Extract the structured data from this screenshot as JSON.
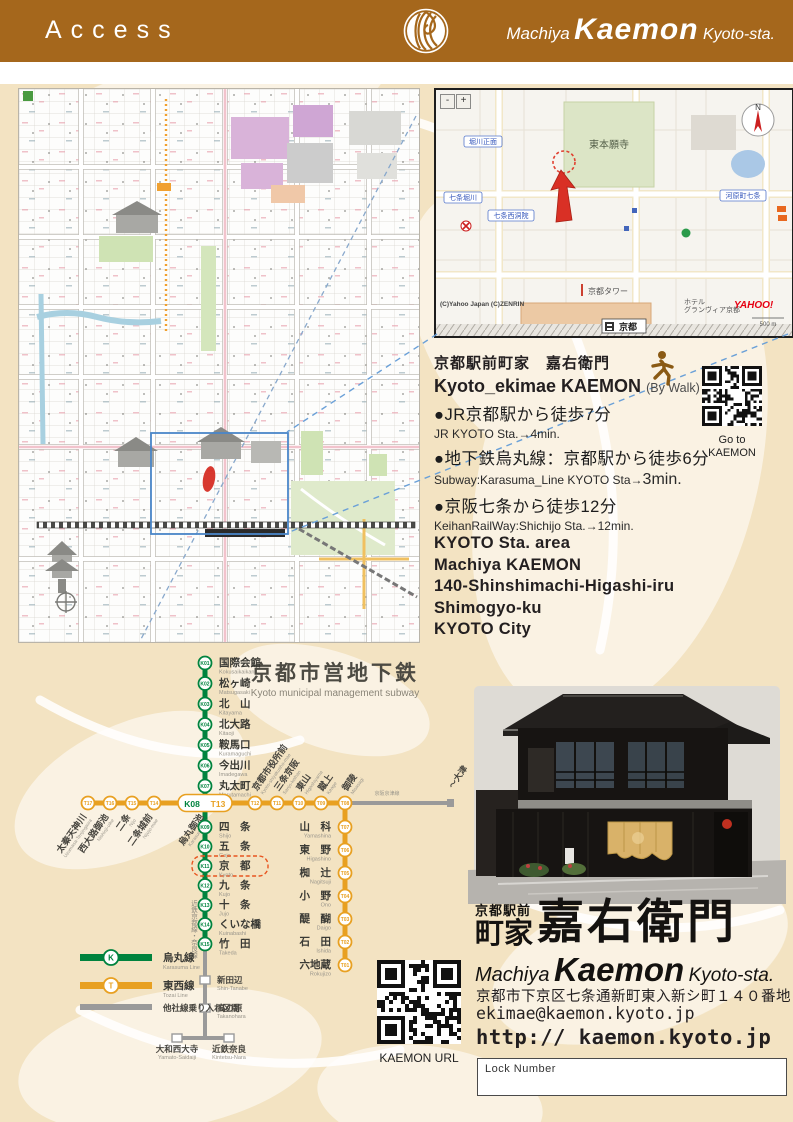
{
  "header": {
    "title": "Access",
    "brand_machiya": "Machiya",
    "brand_name": "Kaemon",
    "brand_suffix": "Kyoto-sta."
  },
  "inset_map": {
    "zoom_out": "-",
    "zoom_in": "+",
    "compass": "N",
    "labels": {
      "honganji": "東本願寺",
      "street_box_1": "堀川正面",
      "street_box_2": "七条堀川",
      "street_box_3": "七条西洞院",
      "street_box_4": "河原町七条",
      "tower": "京都タワー",
      "hotel_1": "ホテル",
      "hotel_2": "グランヴィア京都",
      "isetan": "伊勢丹",
      "station": "京都",
      "attribution": "(C)Yahoo Japan (C)ZENRIN",
      "logo": "YAHOO!",
      "scale": "500 m"
    }
  },
  "access": {
    "title_jp": "京都駅前町家　嘉右衛門",
    "title_en": "Kyoto_ekimae KAEMON",
    "by_walk": "(By Walk)",
    "routes": [
      {
        "jp": "●JR京都駅から徒歩7分",
        "en": "JR KYOTO Sta.→4min."
      },
      {
        "jp": "●地下鉄烏丸線：京都駅から徒歩6分",
        "en": "Subway:Karasuma_Line KYOTO Sta→",
        "en_big": "3min."
      },
      {
        "jp": "●京阪七条から徒歩12分",
        "en": "KeihanRailWay:Shichijo Sta.→12min."
      }
    ],
    "qr_caption_1": "Go to",
    "qr_caption_2": "KAEMON",
    "address_lines": [
      "KYOTO Sta. area",
      "Machiya KAEMON",
      "140-Shinshimachi-Higashi-iru",
      "Shimogyo-ku",
      "KYOTO City"
    ]
  },
  "subway": {
    "title": "京都市営地下鉄",
    "subtitle": "Kyoto municipal management subway",
    "karasuma_upper": [
      {
        "code": "K01",
        "name": "国際会館",
        "romaji": "Kokusaikaikan"
      },
      {
        "code": "K02",
        "name": "松ヶ崎",
        "romaji": "Matsugasaki"
      },
      {
        "code": "K03",
        "name": "北　山",
        "romaji": "Kitayama"
      },
      {
        "code": "K04",
        "name": "北大路",
        "romaji": "Kitaoji"
      },
      {
        "code": "K05",
        "name": "鞍馬口",
        "romaji": "Kuramaguchi"
      },
      {
        "code": "K06",
        "name": "今出川",
        "romaji": "Imadegawa"
      },
      {
        "code": "K07",
        "name": "丸太町",
        "romaji": "Marutamachi"
      }
    ],
    "junction": {
      "codes": [
        "K08",
        "T13"
      ],
      "name": "烏丸御池",
      "romaji": "Karasuma-oike"
    },
    "karasuma_lower": [
      {
        "code": "K09",
        "name": "四　条",
        "romaji": "Shijo"
      },
      {
        "code": "K10",
        "name": "五　条",
        "romaji": "Gojo"
      },
      {
        "code": "K11",
        "name": "京　都",
        "romaji": "Kyoto",
        "highlight": true
      },
      {
        "code": "K12",
        "name": "九　条",
        "romaji": "Kujo"
      },
      {
        "code": "K13",
        "name": "十　条",
        "romaji": "Jujo"
      },
      {
        "code": "K14",
        "name": "くいな橋",
        "romaji": "Kuinabashi"
      },
      {
        "code": "K15",
        "name": "竹　田",
        "romaji": "Takeda"
      }
    ],
    "tozai_left": [
      {
        "code": "T17",
        "name": "太秦天神川",
        "romaji": "Uzumasa-Tenjingawa"
      },
      {
        "code": "T16",
        "name": "西大路御池",
        "romaji": "Nishioji-oike"
      },
      {
        "code": "T15",
        "name": "二条",
        "romaji": "Nijo"
      },
      {
        "code": "T14",
        "name": "二条城前",
        "romaji": "Nijojo-mae"
      }
    ],
    "tozai_right": [
      {
        "code": "T12",
        "name": "京都市役所前",
        "romaji": "Kyoto-shiyakusho-mae"
      },
      {
        "code": "T11",
        "name": "三条京阪",
        "romaji": "Sanjo-keihan"
      },
      {
        "code": "T10",
        "name": "東山",
        "romaji": "Higashiyama"
      },
      {
        "code": "T09",
        "name": "蹴上",
        "romaji": "Keage"
      },
      {
        "code": "T08",
        "name": "御陵",
        "romaji": "Misasagi"
      }
    ],
    "tozai_down": [
      {
        "code": "T07",
        "name": "山　科",
        "romaji": "Yamashina"
      },
      {
        "code": "T06",
        "name": "東　野",
        "romaji": "Higashino"
      },
      {
        "code": "T05",
        "name": "椥　辻",
        "romaji": "Nagitsuji"
      },
      {
        "code": "T04",
        "name": "小　野",
        "romaji": "Ono"
      },
      {
        "code": "T03",
        "name": "醍　醐",
        "romaji": "Daigo"
      },
      {
        "code": "T02",
        "name": "石　田",
        "romaji": "Ishida"
      },
      {
        "code": "T01",
        "name": "六地蔵",
        "romaji": "Rokujizo"
      }
    ],
    "kintetsu": {
      "label": "近鉄京都線・奈良線",
      "stations": [
        {
          "name": "新田辺",
          "romaji": "Shin-Tanabe"
        },
        {
          "name": "高の原",
          "romaji": "Takanohara"
        }
      ],
      "terminals": [
        {
          "name": "大和西大寺",
          "romaji": "Yamato-Saidaiji"
        },
        {
          "name": "近鉄奈良",
          "romaji": "Kintetsu-Nara"
        }
      ]
    },
    "keihan": {
      "label": "京阪京津線",
      "dest": "～大津"
    },
    "legend": [
      {
        "symbol": "K",
        "name": "烏丸線",
        "romaji": "Karasuma Line",
        "color": "#00833e"
      },
      {
        "symbol": "T",
        "name": "東西線",
        "romaji": "Tozai Line",
        "color": "#e8a021"
      },
      {
        "symbol": "",
        "name": "他社線乗り入れ区間",
        "romaji": "",
        "color": "#9a9a9a"
      }
    ],
    "colors": {
      "karasuma": "#00833e",
      "tozai": "#e8a021",
      "other": "#9a9a9a",
      "highlight": "#e85520"
    }
  },
  "footer": {
    "logo_small_top": "京都駅前",
    "logo_small_bottom": "町家",
    "logo_large": "嘉右衛門",
    "logo_en_machiya": "Machiya",
    "logo_en_name": "Kaemon",
    "logo_en_suffix": "Kyoto-sta.",
    "address_jp": "京都市下京区七条通新町東入新シ町１４０番地",
    "email": "ekimae@kaemon.kyoto.jp",
    "url": "http:// kaemon.kyoto.jp",
    "qr_caption": "KAEMON URL",
    "lock_label": "Lock Number"
  }
}
